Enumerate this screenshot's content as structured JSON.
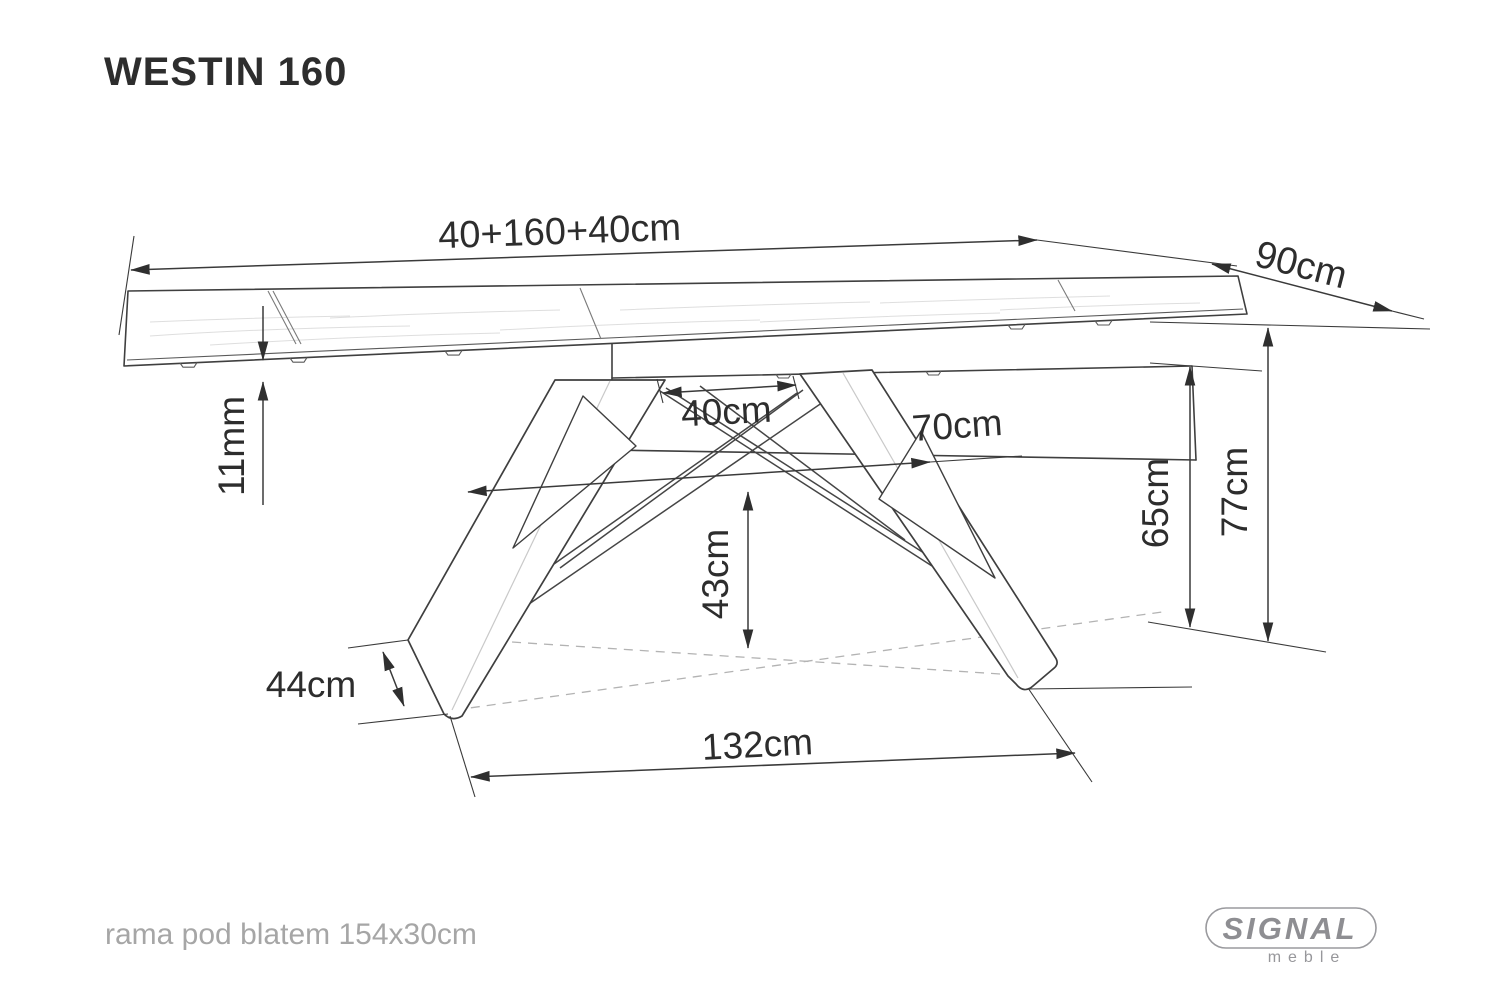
{
  "title": "WESTIN 160",
  "dimensions": {
    "top_length": {
      "label": "40+160+40cm"
    },
    "depth": {
      "label": "90cm"
    },
    "top_thickness": {
      "label": "11mm"
    },
    "leaf": {
      "label": "40cm"
    },
    "leg_span": {
      "label": "70cm"
    },
    "frame_height": {
      "label": "65cm"
    },
    "table_height": {
      "label": "77cm"
    },
    "clearance": {
      "label": "43cm"
    },
    "foot": {
      "label": "44cm"
    },
    "base": {
      "label": "132cm"
    }
  },
  "footer": {
    "note": "rama pod blatem 154x30cm"
  },
  "logo": {
    "brand": "SIGNAL",
    "sub": "meble"
  },
  "colors": {
    "line": "#3f3f3f",
    "text": "#2d2d2d",
    "muted": "#a6a6a6",
    "logo": "#8e8e92"
  }
}
